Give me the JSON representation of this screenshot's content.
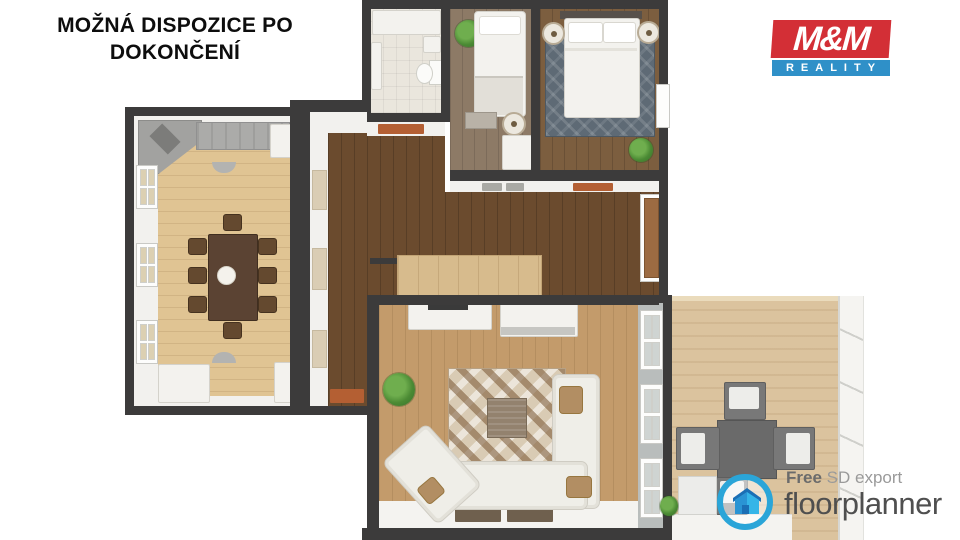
{
  "title": {
    "line1": "MOŽNÁ DISPOZICE PO",
    "line2": "DOKONČENÍ"
  },
  "brand": {
    "name": "M&M",
    "tagline": "REALITY",
    "red": "#d32f36",
    "blue": "#2f90c8"
  },
  "watermark": {
    "prefix_bold": "Free",
    "prefix_rest": " SD export",
    "brand": "floorplanner",
    "ring_color": "#2aa5d8",
    "text_color": "#4f4f4f"
  },
  "floorplan": {
    "wall_color": "#3c3b3b",
    "rooms": [
      {
        "id": "bathroom",
        "floor_color": "#eae6dd",
        "furniture": [
          "shower",
          "sink",
          "toilet"
        ]
      },
      {
        "id": "small-bedroom",
        "floor_color": "#8d7a66",
        "furniture": [
          "single-bed",
          "plant",
          "bench",
          "pouf",
          "wardrobe"
        ]
      },
      {
        "id": "master-bedroom",
        "floor_color": "#7c5e3f",
        "rug_color": "#5e6a75",
        "furniture": [
          "double-bed",
          "two-nightstand-lamps",
          "plant"
        ]
      },
      {
        "id": "dining-room",
        "floor_color": "#e0c493",
        "furniture": [
          "kitchen-counter",
          "corner-unit",
          "fridge",
          "dining-table",
          "8-chairs",
          "two-sideboards",
          "three-windows"
        ]
      },
      {
        "id": "hallway",
        "floor_color": "#6b4b2e",
        "furniture": [
          "stairs-block",
          "interior-door",
          "doormats"
        ]
      },
      {
        "id": "living-room",
        "floor_color": "#c39b6b",
        "rug_color": "#d9cbb4",
        "furniture": [
          "corner-sofa",
          "coffee-table",
          "patterned-rug",
          "tv-console",
          "media-cabinet",
          "plant",
          "window-wall"
        ]
      },
      {
        "id": "terrace",
        "floor_color": "#dbc39e",
        "furniture": [
          "square-table",
          "four-cube-chairs",
          "white-cube",
          "stone-wall",
          "plant"
        ]
      }
    ]
  }
}
